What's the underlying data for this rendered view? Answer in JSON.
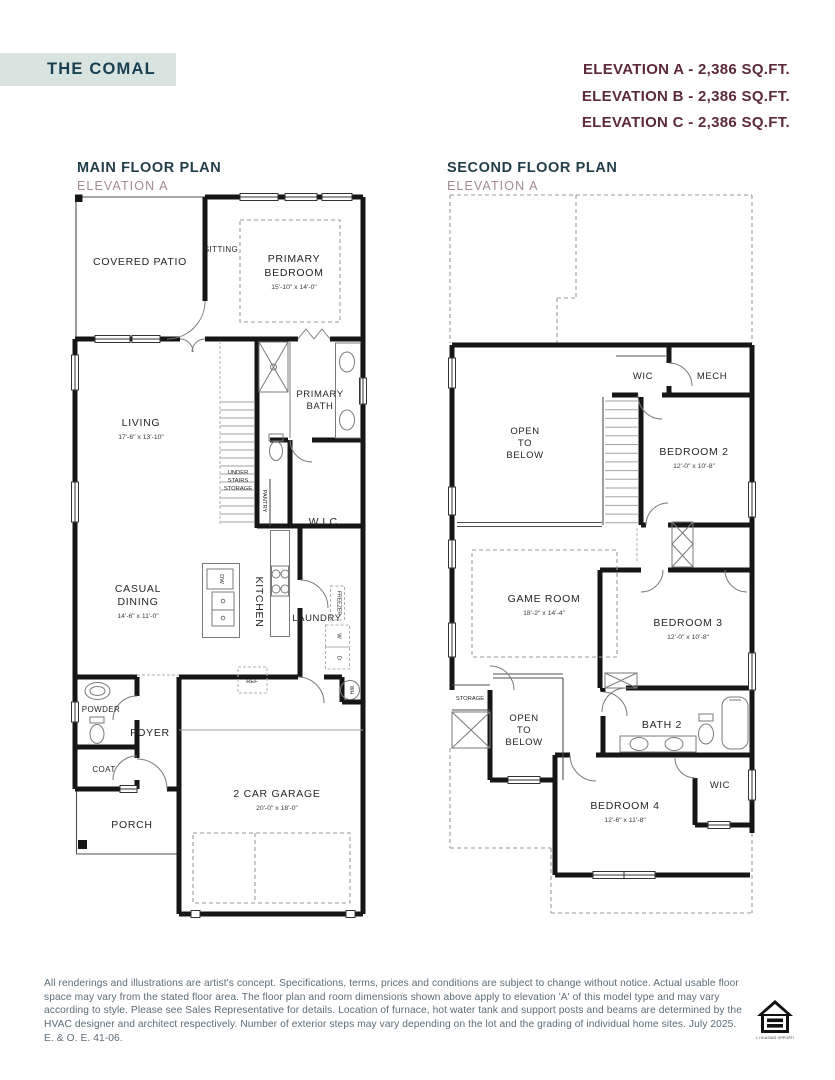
{
  "header": {
    "title": "THE COMAL",
    "elevations": [
      "ELEVATION A - 2,386 SQ.FT.",
      "ELEVATION B - 2,386 SQ.FT.",
      "ELEVATION C - 2,386 SQ.FT."
    ]
  },
  "colors": {
    "title_bg": "#d9e4e0",
    "title_text": "#173f4f",
    "elevation_text": "#5d2a3a",
    "plan_title": "#223e4a",
    "plan_subtitle": "#a38b92",
    "wall": "#161616",
    "disclaimer_text": "#5c6c76"
  },
  "main": {
    "title": "MAIN FLOOR PLAN",
    "subtitle": "ELEVATION A",
    "labels": {
      "covered_patio": "COVERED PATIO",
      "sitting": "SITTING",
      "primary_1": "PRIMARY",
      "primary_2": "BEDROOM",
      "primary_dims": "15'-10\" x 14'-0\"",
      "living": "LIVING",
      "living_dims": "17'-6\" x 13'-10\"",
      "primary_bath_1": "PRIMARY",
      "primary_bath_2": "BATH",
      "under_1": "UNDER",
      "under_2": "STAIRS",
      "under_3": "STORAGE",
      "pantry": "PANTRY",
      "wic": "W.I.C.",
      "casual_1": "CASUAL",
      "casual_2": "DINING",
      "casual_dims": "14'-6\" x 11'-0\"",
      "kitchen": "KITCHEN",
      "dw": "DW",
      "laundry": "LAUNDRY",
      "freezer": "FREEZER",
      "washer": "W",
      "dryer": "D",
      "ref": "REF",
      "powder": "POWDER",
      "foyer": "FOYER",
      "coat": "COAT",
      "porch": "PORCH",
      "garage": "2 CAR GARAGE",
      "garage_dims": "20'-0\" x 18'-0\"",
      "wh": "WH"
    }
  },
  "second": {
    "title": "SECOND FLOOR PLAN",
    "subtitle": "ELEVATION A",
    "labels": {
      "wic_top": "WIC",
      "mech": "MECH",
      "open1_1": "OPEN",
      "open1_2": "TO",
      "open1_3": "BELOW",
      "bedroom2": "BEDROOM 2",
      "bedroom2_dims": "12'-0\" x 10'-8\"",
      "game_room": "GAME ROOM",
      "game_room_dims": "18'-2\" x 14'-4\"",
      "bedroom3": "BEDROOM 3",
      "bedroom3_dims": "12'-0\" x 10'-8\"",
      "storage": "STORAGE",
      "open2_1": "OPEN",
      "open2_2": "TO",
      "open2_3": "BELOW",
      "bath2": "BATH 2",
      "bedroom4": "BEDROOM 4",
      "bedroom4_dims": "12'-6\" x 11'-8\"",
      "wic_b4": "WIC"
    }
  },
  "footer": {
    "disclaimer": "All renderings and illustrations are artist's concept. Specifications, terms, prices and conditions are subject to change without notice. Actual usable floor space may vary from the stated floor area. The floor plan and room dimensions shown above apply to elevation 'A' of this model type and may vary according to style. Please see Sales Representative for details. Location of furnace, hot water tank and support posts and beams are determined by the HVAC designer and architect respectively. Number of exterior steps may vary depending on the lot and the grading of individual home sites. July 2025. E. & O. E. 41-06.",
    "logo_text": "EQUAL HOUSING OPPORTUNITY"
  }
}
